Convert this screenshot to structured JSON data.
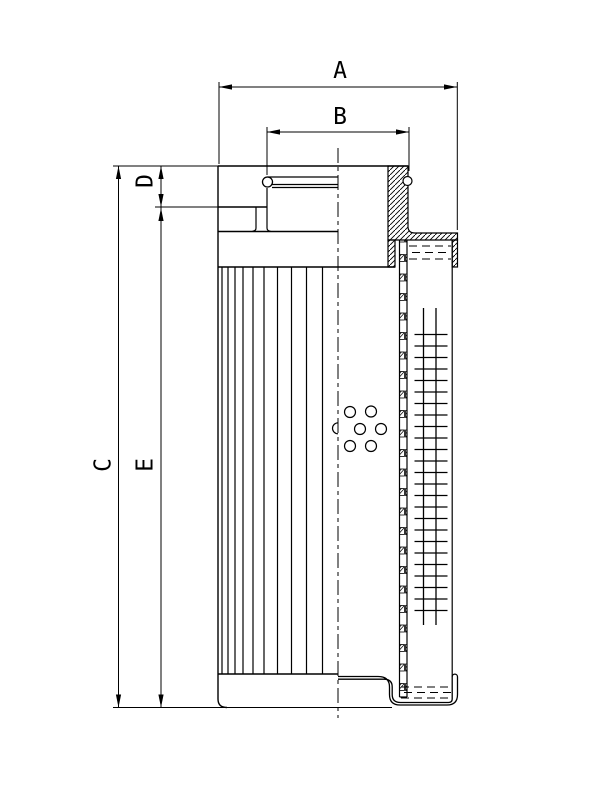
{
  "drawing": {
    "background_color": "#ffffff",
    "line_color": "#000000",
    "dimension_labels": {
      "A": "A",
      "B": "B",
      "C": "C",
      "D": "D",
      "E": "E"
    }
  }
}
